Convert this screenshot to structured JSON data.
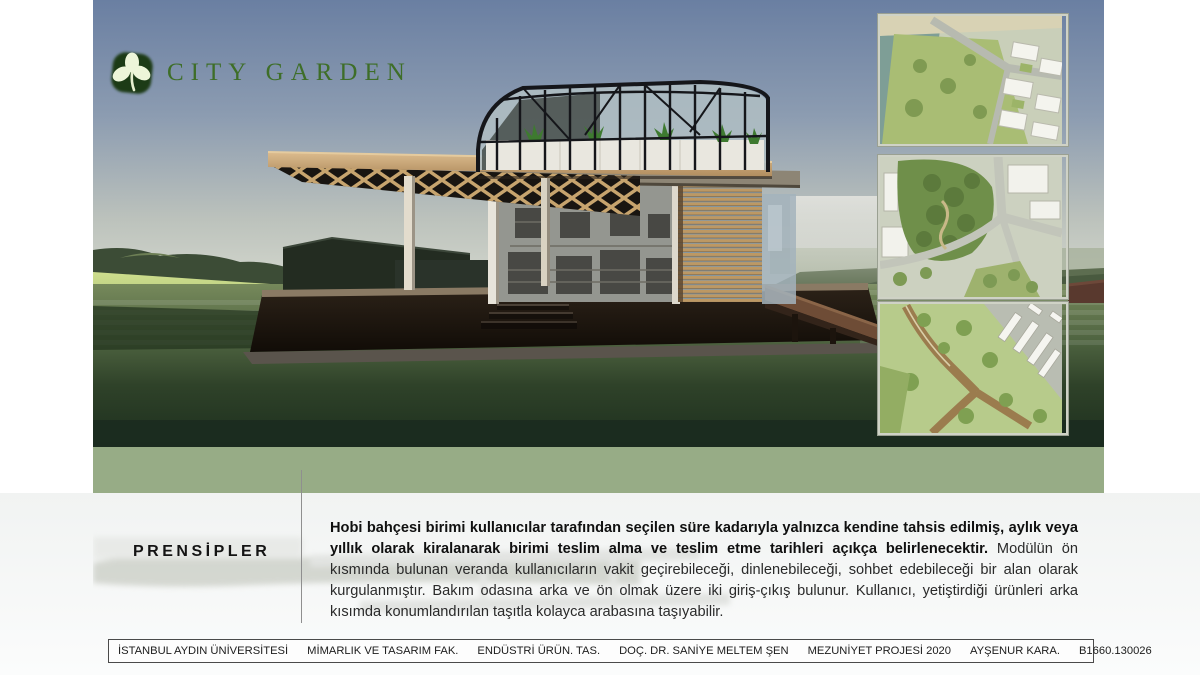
{
  "logo": {
    "icon": "leaf-logo-icon",
    "text": "CITY GARDEN"
  },
  "hero": {
    "description_names": [
      "pavilion-render",
      "rooftop-greenhouse",
      "timber-canopy",
      "louver-screen",
      "deck-ramp"
    ],
    "thumbnails": [
      "aerial-site-plan-waterfront",
      "aerial-site-plan-park",
      "aerial-site-plan-paths-parking"
    ]
  },
  "principles": {
    "heading": "PRENSİPLER",
    "lead": "Hobi bahçesi birimi kullanıcılar tarafından seçilen süre kadarıyla yalnızca kendine tahsis edilmiş, aylık veya yıllık olarak kiralanarak birimi teslim alma ve teslim etme tarihleri açıkça belirlenecektir.",
    "body": " Modülün ön kısmında bulunan veranda kullanıcıların vakit geçirebileceği, dinlenebileceği, sohbet edebileceği bir alan olarak kurgulanmıştır. Bakım odasına arka ve ön olmak üzere iki giriş-çıkış bulunur. Kullanıcı, yetiştirdiği ürünleri arka kısımda konumlandırılan taşıtla kolayca arabasına taşıyabilir."
  },
  "footer": {
    "items": [
      "İSTANBUL AYDIN ÜNİVERSİTESİ",
      "MİMARLIK VE TASARIM FAK.",
      "ENDÜSTRİ ÜRÜN. TAS.",
      "DOÇ. DR. SANİYE MELTEM ŞEN",
      "MEZUNİYET PROJESİ 2020",
      "AYŞENUR KARA.",
      "B1660.130026"
    ]
  },
  "colors": {
    "band": "#97ac86",
    "logo": "#3e6e28",
    "divider": "#8f8f8f",
    "text": "#2a2a2a"
  }
}
